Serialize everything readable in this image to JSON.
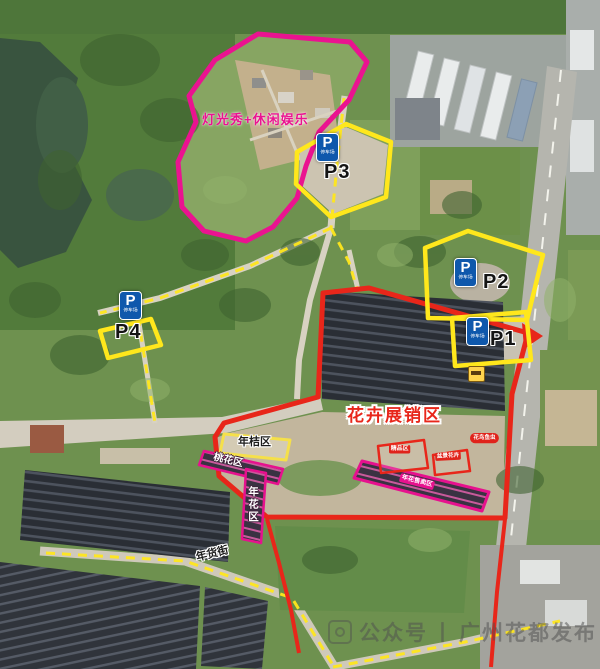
{
  "map": {
    "light_show_zone": {
      "label": "灯光秀+休闲娱乐"
    },
    "flower_expo_zone": {
      "title": "花卉展销区",
      "sub_labels": {
        "kumquat": "年桔区",
        "peach": "桃花区",
        "new_year_flower": "年花区",
        "goods_street": "年货街",
        "boutique": "精品区",
        "bonsai": "盆景花卉",
        "flower_sale": "年花售卖区",
        "flower_bird_fish": "花鸟鱼虫"
      }
    },
    "parking": {
      "sign_letter": "P",
      "sign_sub": "停车场",
      "lots": [
        "P1",
        "P2",
        "P3",
        "P4"
      ]
    },
    "watermark": {
      "prefix": "公众号",
      "separator": "丨",
      "account": "广州花都发布"
    },
    "colors": {
      "light_show_outline": "#ea1390",
      "parking_outline": "#ffe71c",
      "expo_outline": "#e8261a",
      "parking_sign_blue": "#0f58ac",
      "strip_pink": "#e6118e"
    }
  }
}
